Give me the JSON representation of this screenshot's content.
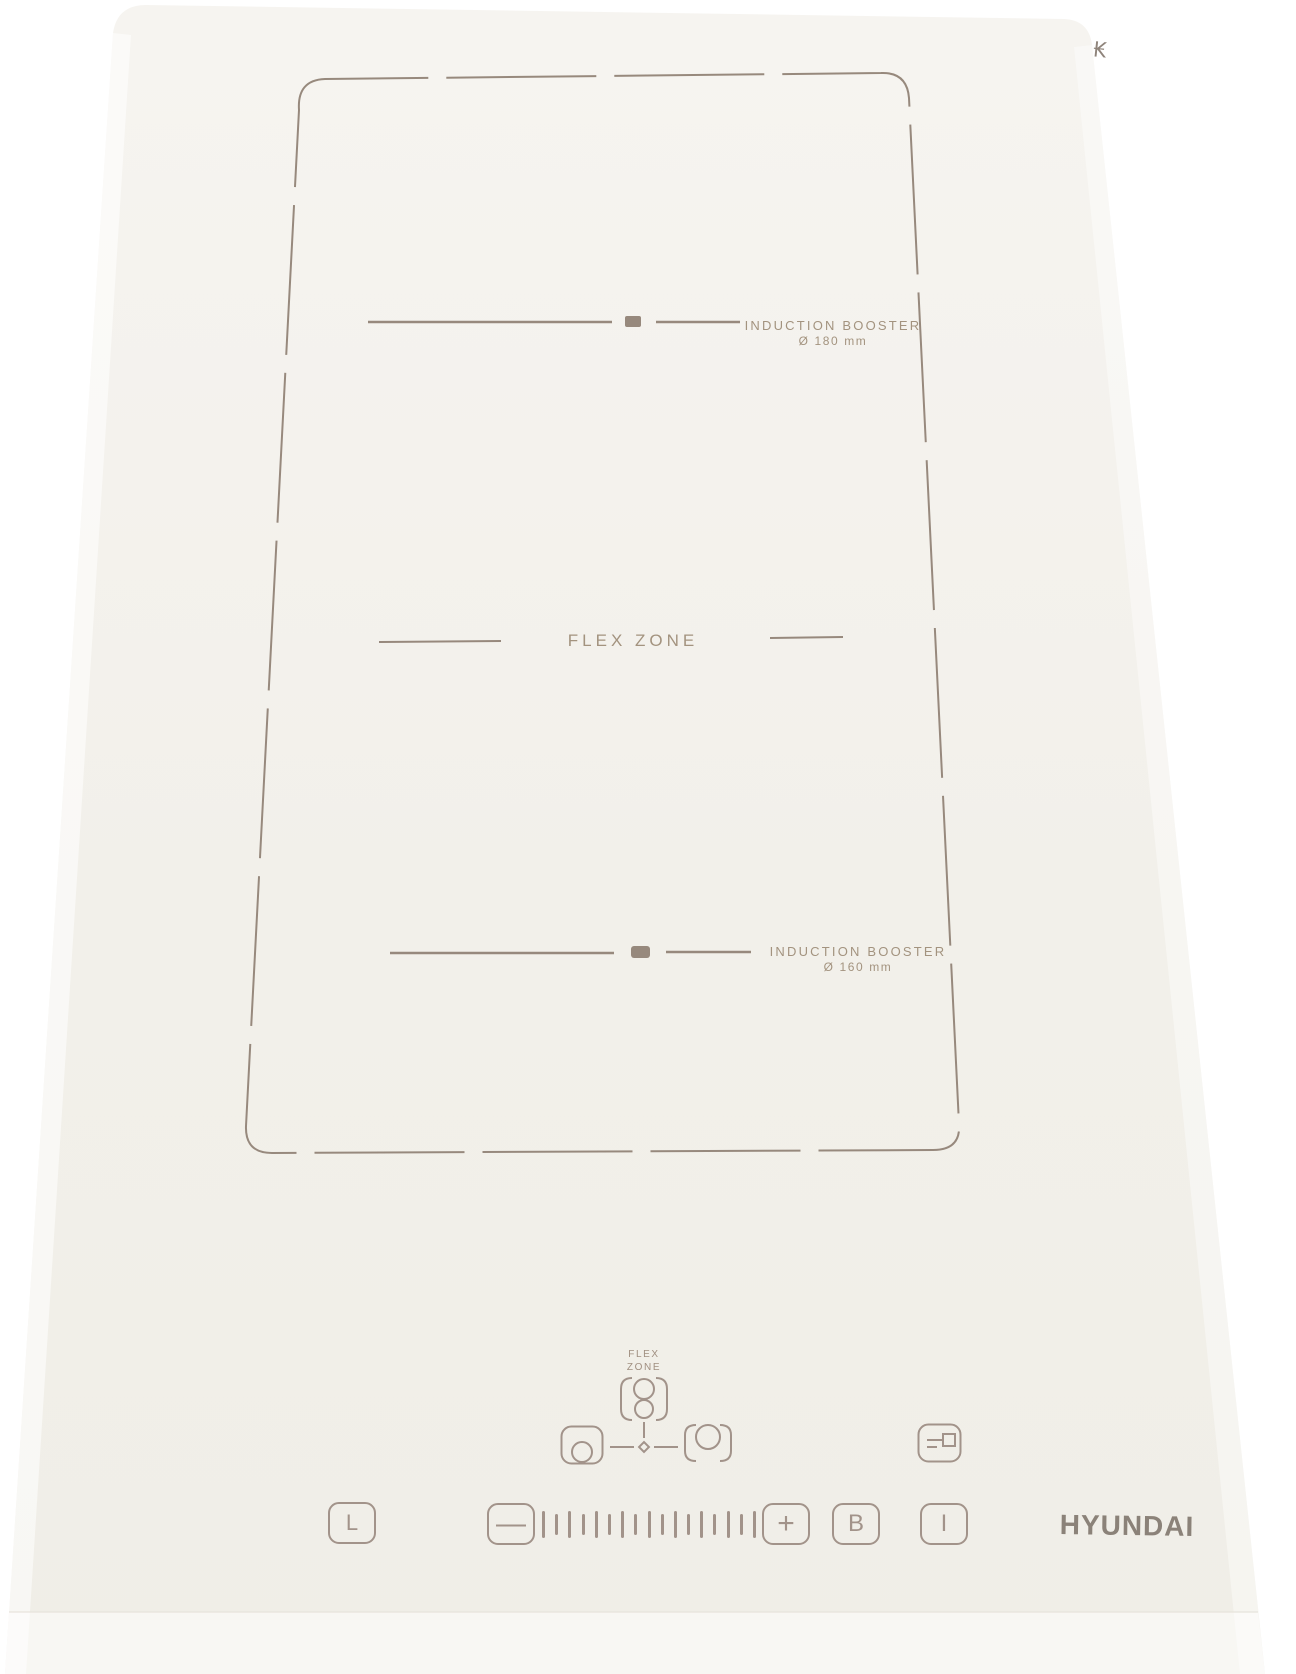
{
  "marks": {
    "glass_mark": "₭"
  },
  "zones": {
    "top": {
      "name": "INDUCTION BOOSTER",
      "diameter": "Ø 180 mm"
    },
    "flex": {
      "name": "FLEX ZONE"
    },
    "bottom": {
      "name": "INDUCTION BOOSTER",
      "diameter": "Ø 160 mm"
    }
  },
  "controls": {
    "flex_selector": {
      "line1": "FLEX",
      "line2": "ZONE"
    },
    "lock_label": "L",
    "minus_label": "—",
    "plus_label": "+",
    "booster_label": "B",
    "power_label": "I",
    "slider_tick_count": 17
  },
  "branding": {
    "logo": "HYUNDAI"
  },
  "colors": {
    "background": "#ffffff",
    "glass": "#f2f0ea",
    "etch_line": "#97897d",
    "etch_text": "#a3937f",
    "logo": "#8b8279"
  }
}
